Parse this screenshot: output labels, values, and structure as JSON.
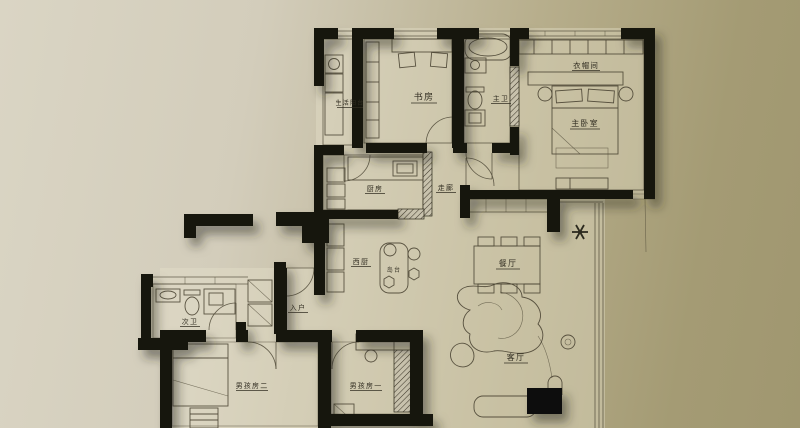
{
  "title": "apartment-floor-plan",
  "palette": {
    "background_left": "#d8d3c2",
    "background_right": "#a39a72",
    "wall": "#17140e",
    "line": "#4e4836",
    "label": "#332f23"
  },
  "rooms": [
    {
      "id": "utility-balcony",
      "label": "生活阳台"
    },
    {
      "id": "study",
      "label": "书房"
    },
    {
      "id": "master-bath",
      "label": "主卫"
    },
    {
      "id": "cloakroom",
      "label": "衣帽间"
    },
    {
      "id": "master-bedroom",
      "label": "主卧室"
    },
    {
      "id": "kitchen",
      "label": "厨房"
    },
    {
      "id": "corridor",
      "label": "走廊"
    },
    {
      "id": "west-kitchen",
      "label": "西厨"
    },
    {
      "id": "island",
      "label": "岛台"
    },
    {
      "id": "dining-room",
      "label": "餐厅"
    },
    {
      "id": "entry",
      "label": "入户"
    },
    {
      "id": "second-bath",
      "label": "次卫"
    },
    {
      "id": "boys-room-2",
      "label": "男孩房二"
    },
    {
      "id": "boys-room-1",
      "label": "男孩房一"
    },
    {
      "id": "living-room",
      "label": "客厅"
    }
  ]
}
